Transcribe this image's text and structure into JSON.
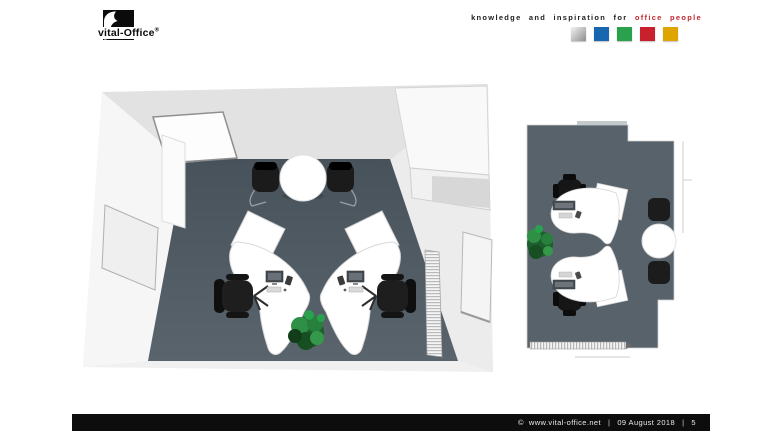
{
  "header": {
    "brand": {
      "name": "vital-Office",
      "registered": "®"
    },
    "tagline": {
      "prefix": "knowledge and inspiration for",
      "highlight": "office people",
      "highlight_color": "#c1272d"
    },
    "squares": [
      {
        "name": "silver",
        "gradient_from": "#f2f2f2",
        "gradient_to": "#8e8e8e"
      },
      {
        "name": "blue",
        "color": "#1766b0"
      },
      {
        "name": "green",
        "color": "#2aa14d"
      },
      {
        "name": "red",
        "color": "#c8202d"
      },
      {
        "name": "yellow",
        "color": "#dea500"
      }
    ]
  },
  "main": {
    "floorplans": [
      {
        "id": "office-room-perspective-view"
      },
      {
        "id": "office-room-plan-view"
      }
    ],
    "colors": {
      "floor": "#4f5a62",
      "floor_light": "#5a656e",
      "wall": "#e9e9e9",
      "desk": "#ffffff",
      "chair": "#1d1d1d",
      "plant": "#2e7d3b"
    }
  },
  "footer": {
    "copyright": "©  www.vital-office.net",
    "separator": "|",
    "date": "09 August 2018",
    "page": "5"
  }
}
